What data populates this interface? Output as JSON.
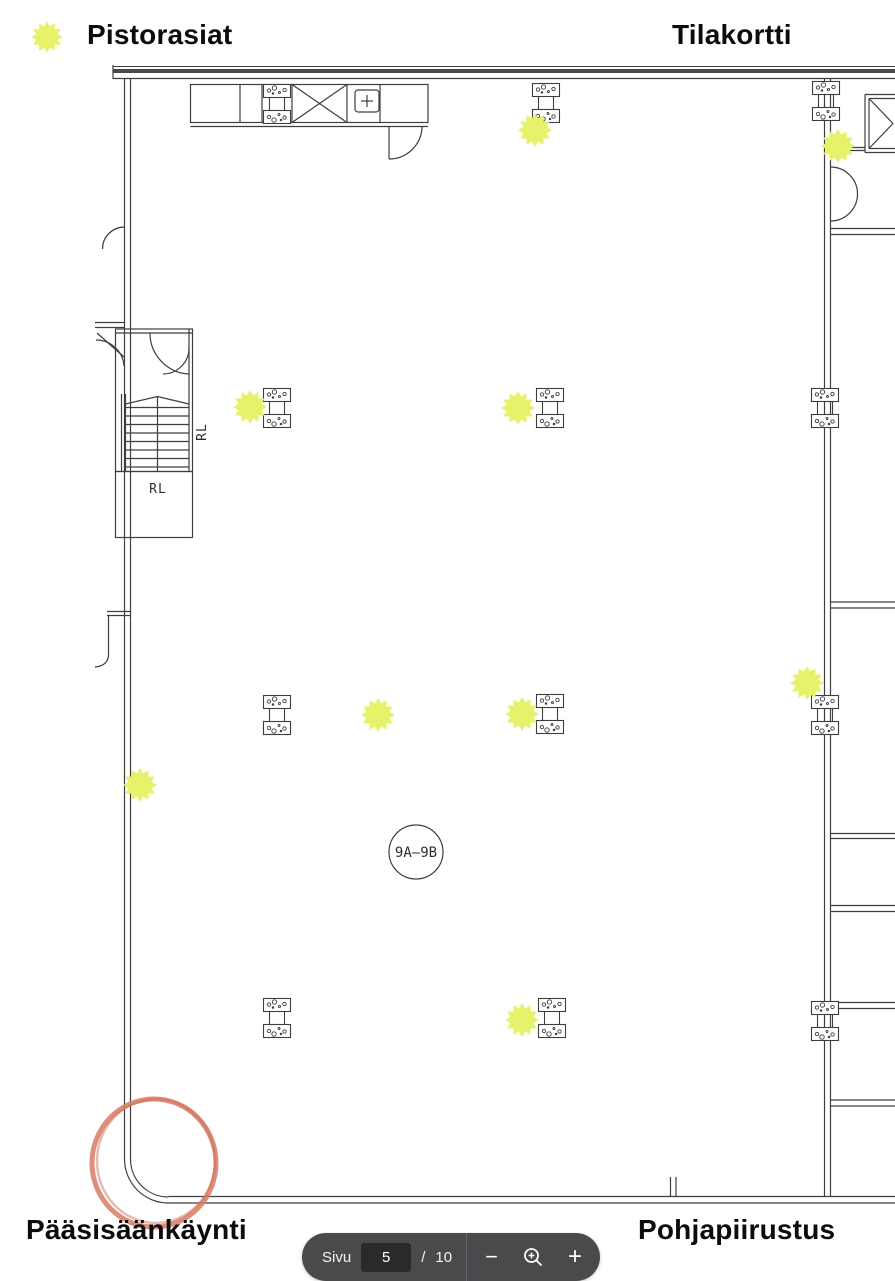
{
  "header": {
    "legend_label": "Pistorasiat",
    "right_label": "Tilakortti"
  },
  "footer": {
    "left_label": "Pääsisäänkäynti",
    "right_label": "Pohjapiirustus"
  },
  "pager": {
    "page_label": "Sivu",
    "current_page": "5",
    "separator": "/",
    "total_pages": "10",
    "zoom_out_symbol": "−",
    "zoom_in_symbol": "+"
  },
  "plan": {
    "room_circle_label": "9A–9B",
    "stairs_label_side": "RL",
    "stairs_label_bottom": "RL",
    "markers": [
      {
        "x": 535,
        "y": 130
      },
      {
        "x": 838,
        "y": 146
      },
      {
        "x": 250,
        "y": 407
      },
      {
        "x": 518,
        "y": 408
      },
      {
        "x": 140,
        "y": 785
      },
      {
        "x": 378,
        "y": 715
      },
      {
        "x": 522,
        "y": 714
      },
      {
        "x": 807,
        "y": 683
      },
      {
        "x": 522,
        "y": 1020
      }
    ],
    "outlets": [
      {
        "x": 277,
        "y": 104
      },
      {
        "x": 546,
        "y": 103
      },
      {
        "x": 826,
        "y": 101
      },
      {
        "x": 277,
        "y": 408
      },
      {
        "x": 550,
        "y": 408
      },
      {
        "x": 825,
        "y": 408
      },
      {
        "x": 277,
        "y": 715
      },
      {
        "x": 550,
        "y": 714
      },
      {
        "x": 825,
        "y": 715
      },
      {
        "x": 277,
        "y": 1018
      },
      {
        "x": 552,
        "y": 1018
      },
      {
        "x": 825,
        "y": 1021
      }
    ],
    "annotation_circle": {
      "cx": 154,
      "cy": 1163,
      "rx": 62,
      "ry": 64
    }
  },
  "colors": {
    "marker_fill": "#e7f26b",
    "annotation_stroke": "#d87a63",
    "line": "#3e3e3e",
    "pill_bg": "#4a4a4c",
    "pill_input_bg": "#2a2a2c"
  }
}
